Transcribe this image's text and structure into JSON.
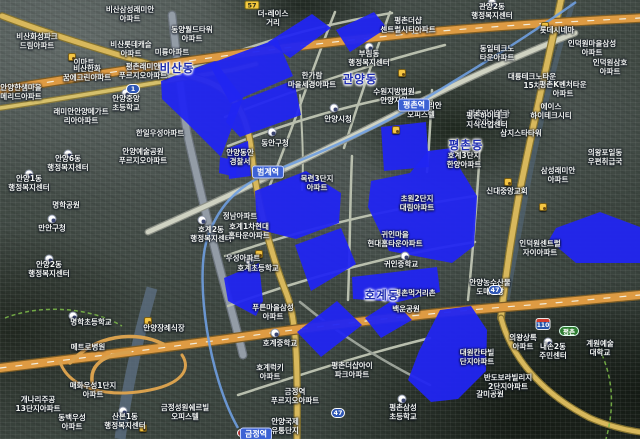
{
  "map": {
    "colors": {
      "zone_fill": "#2125f1",
      "district_text": "#1d2bb0",
      "highway": "#de9b43",
      "highway_casing": "#7d5d26",
      "arterial": "#d8b85c",
      "arterial_casing": "#87742f",
      "minor_road": "#b9bfae",
      "major_gray_road": "#939ca6",
      "subway_line": "#6f9fe0",
      "stream": "#5d7085",
      "park_border": "#7ab648"
    },
    "district_labels": [
      {
        "text": "비산동",
        "x": 177,
        "y": 68
      },
      {
        "text": "관양동",
        "x": 360,
        "y": 79
      },
      {
        "text": "평촌동",
        "x": 466,
        "y": 145
      },
      {
        "text": "호계동",
        "x": 382,
        "y": 295
      }
    ],
    "station_labels": [
      {
        "text": "평촌역",
        "x": 414,
        "y": 105
      },
      {
        "text": "범계역",
        "x": 268,
        "y": 172
      },
      {
        "text": "금정역",
        "x": 256,
        "y": 434
      }
    ],
    "shields": [
      {
        "style": "local",
        "text": "57",
        "x": 252,
        "y": 5
      },
      {
        "style": "national",
        "text": "1",
        "x": 133,
        "y": 89
      },
      {
        "style": "national",
        "text": "47",
        "x": 338,
        "y": 413
      },
      {
        "style": "national",
        "text": "47",
        "x": 495,
        "y": 290
      },
      {
        "style": "expwy",
        "text": "110",
        "x": 543,
        "y": 324
      },
      {
        "style": "ic",
        "text": "평촌",
        "x": 569,
        "y": 331
      }
    ],
    "place_labels": [
      {
        "l": [
          "비산삼성래미안",
          "아파트"
        ],
        "x": 130,
        "y": 14
      },
      {
        "l": [
          "동양월드타워",
          "아파트"
        ],
        "x": 192,
        "y": 34
      },
      {
        "l": [
          "비산화성파크",
          "드림아파트"
        ],
        "x": 37,
        "y": 41
      },
      {
        "l": [
          "비산롯데캐슬",
          "아파트"
        ],
        "x": 131,
        "y": 49
      },
      {
        "l": [
          "미륭아파트"
        ],
        "x": 172,
        "y": 52
      },
      {
        "l": [
          "이마트"
        ],
        "x": 84,
        "y": 62
      },
      {
        "l": [
          "비산한화",
          "꿈에그린아파트"
        ],
        "x": 87,
        "y": 73
      },
      {
        "l": [
          "평촌래미안",
          "푸르지오아파트"
        ],
        "x": 143,
        "y": 71
      },
      {
        "l": [
          "안양한샘마을",
          "메리드아파트"
        ],
        "x": 21,
        "y": 92
      },
      {
        "l": [
          "안양중앙",
          "초등학교"
        ],
        "x": 126,
        "y": 103
      },
      {
        "l": [
          "래미안안양메가트",
          "리아아파트"
        ],
        "x": 81,
        "y": 116
      },
      {
        "l": [
          "한일우성아파트"
        ],
        "x": 160,
        "y": 133
      },
      {
        "l": [
          "더-레이스",
          "거리"
        ],
        "x": 273,
        "y": 18
      },
      {
        "l": [
          "평촌더샵",
          "센트럴시티아파트"
        ],
        "x": 408,
        "y": 25
      },
      {
        "l": [
          "부림동",
          "행정복지센터"
        ],
        "x": 369,
        "y": 58
      },
      {
        "l": [
          "한가람",
          "마을세경아파트"
        ],
        "x": 312,
        "y": 80
      },
      {
        "l": [
          "안양시청"
        ],
        "x": 338,
        "y": 119
      },
      {
        "l": [
          "효성인텔리안",
          "오피스텔"
        ],
        "x": 421,
        "y": 110
      },
      {
        "l": [
          "수원지방법원",
          "안양지원"
        ],
        "x": 394,
        "y": 96
      },
      {
        "l": [
          "동안구청"
        ],
        "x": 275,
        "y": 143
      },
      {
        "l": [
          "관양2동",
          "행정복지센터"
        ],
        "x": 492,
        "y": 11
      },
      {
        "l": [
          "롯데시네마"
        ],
        "x": 557,
        "y": 30
      },
      {
        "l": [
          "인덕원마을삼성",
          "아파트"
        ],
        "x": 592,
        "y": 48
      },
      {
        "l": [
          "동일테크노",
          "타운아파트"
        ],
        "x": 497,
        "y": 53
      },
      {
        "l": [
          "인덕원삼호",
          "아파트"
        ],
        "x": 610,
        "y": 67
      },
      {
        "l": [
          "대륭테크노타운",
          "15차"
        ],
        "x": 532,
        "y": 81
      },
      {
        "l": [
          "평촌K벤처타운",
          "아파트"
        ],
        "x": 563,
        "y": 89
      },
      {
        "l": [
          "에이스",
          "하이테크시티"
        ],
        "x": 551,
        "y": 111
      },
      {
        "l": [
          "평촌자이엘라",
          "오피스텔"
        ],
        "x": 489,
        "y": 118
      },
      {
        "l": [
          "삼지스타타워"
        ],
        "x": 521,
        "y": 133
      },
      {
        "l": [
          "평촌하이테크",
          "지식산업센터"
        ],
        "x": 487,
        "y": 120
      },
      {
        "l": [
          "호계3단지",
          "한양아파트"
        ],
        "x": 464,
        "y": 160
      },
      {
        "l": [
          "삼성래미안",
          "아파트"
        ],
        "x": 558,
        "y": 175
      },
      {
        "l": [
          "의왕포일동",
          "우편취급국"
        ],
        "x": 605,
        "y": 157
      },
      {
        "l": [
          "신대중앙교회"
        ],
        "x": 507,
        "y": 191
      },
      {
        "l": [
          "내손2동",
          "주민센터"
        ],
        "x": 553,
        "y": 351
      },
      {
        "l": [
          "인덕원센트럴",
          "자이아파트"
        ],
        "x": 540,
        "y": 248
      },
      {
        "l": [
          "안양6동",
          "행정복지센터"
        ],
        "x": 68,
        "y": 163
      },
      {
        "l": [
          "안양예술공원",
          "푸르지오아파트"
        ],
        "x": 143,
        "y": 156
      },
      {
        "l": [
          "안양1동",
          "행정복지센터"
        ],
        "x": 29,
        "y": 183
      },
      {
        "l": [
          "명학공원"
        ],
        "x": 66,
        "y": 205
      },
      {
        "l": [
          "만안구청"
        ],
        "x": 52,
        "y": 228
      },
      {
        "l": [
          "호계2동",
          "행정복지센터"
        ],
        "x": 211,
        "y": 234
      },
      {
        "l": [
          "안양2동",
          "행정복지센터"
        ],
        "x": 49,
        "y": 269
      },
      {
        "l": [
          "안양동안",
          "경찰서"
        ],
        "x": 240,
        "y": 157
      },
      {
        "l": [
          "정남아파트"
        ],
        "x": 240,
        "y": 216
      },
      {
        "l": [
          "호계1차현대",
          "홈타운아파트"
        ],
        "x": 249,
        "y": 231
      },
      {
        "l": [
          "우성아파트"
        ],
        "x": 243,
        "y": 258
      },
      {
        "l": [
          "호계초등학교"
        ],
        "x": 258,
        "y": 268
      },
      {
        "l": [
          "목련3단지",
          "아파트"
        ],
        "x": 317,
        "y": 183
      },
      {
        "l": [
          "초원2단지",
          "대림아파트"
        ],
        "x": 417,
        "y": 203
      },
      {
        "l": [
          "귀인마을",
          "현대홈타운아파트"
        ],
        "x": 395,
        "y": 239
      },
      {
        "l": [
          "귀인중학교"
        ],
        "x": 401,
        "y": 264
      },
      {
        "l": [
          "안양농수산물",
          "도매시장"
        ],
        "x": 490,
        "y": 287
      },
      {
        "l": [
          "평촌먹거리촌"
        ],
        "x": 415,
        "y": 293
      },
      {
        "l": [
          "백운공원"
        ],
        "x": 406,
        "y": 309
      },
      {
        "l": [
          "갈미공원"
        ],
        "x": 490,
        "y": 394
      },
      {
        "l": [
          "계원예술",
          "대학교"
        ],
        "x": 600,
        "y": 348
      },
      {
        "l": [
          "대원칸타빌",
          "단지아파트"
        ],
        "x": 477,
        "y": 357
      },
      {
        "l": [
          "반도보라빌리지",
          "2단지아파트"
        ],
        "x": 508,
        "y": 382
      },
      {
        "l": [
          "의왕상록",
          "아파트"
        ],
        "x": 523,
        "y": 342
      },
      {
        "l": [
          "명학초등학교"
        ],
        "x": 91,
        "y": 322
      },
      {
        "l": [
          "메트로병원"
        ],
        "x": 88,
        "y": 347
      },
      {
        "l": [
          "안양장례식장"
        ],
        "x": 164,
        "y": 328
      },
      {
        "l": [
          "매화우성1단지",
          "아파트"
        ],
        "x": 93,
        "y": 390
      },
      {
        "l": [
          "개나리주공",
          "13단지아파트"
        ],
        "x": 38,
        "y": 404
      },
      {
        "l": [
          "동백우성",
          "아파트"
        ],
        "x": 72,
        "y": 422
      },
      {
        "l": [
          "산본1동",
          "행정복지센터"
        ],
        "x": 125,
        "y": 421
      },
      {
        "l": [
          "금정성원쉐르빌",
          "오피스텔"
        ],
        "x": 185,
        "y": 412
      },
      {
        "l": [
          "금정역",
          "푸르지오아파트"
        ],
        "x": 295,
        "y": 396
      },
      {
        "l": [
          "안양국제",
          "유통단지"
        ],
        "x": 285,
        "y": 426
      },
      {
        "l": [
          "푸른마을삼성",
          "아파트"
        ],
        "x": 273,
        "y": 312
      },
      {
        "l": [
          "호계중학교"
        ],
        "x": 280,
        "y": 343
      },
      {
        "l": [
          "호계럭키",
          "아파트"
        ],
        "x": 270,
        "y": 372
      },
      {
        "l": [
          "평촌더샵아이",
          "파크아파트"
        ],
        "x": 352,
        "y": 370
      },
      {
        "l": [
          "평촌삼성",
          "초등학교"
        ],
        "x": 403,
        "y": 412
      }
    ],
    "markers": [
      {
        "type": "civic",
        "x": 369,
        "y": 47
      },
      {
        "type": "civic",
        "x": 334,
        "y": 108
      },
      {
        "type": "civic",
        "x": 272,
        "y": 132
      },
      {
        "type": "civic",
        "x": 492,
        "y": 3
      },
      {
        "type": "civic",
        "x": 126,
        "y": 93
      },
      {
        "type": "civic",
        "x": 68,
        "y": 154
      },
      {
        "type": "civic",
        "x": 29,
        "y": 174
      },
      {
        "type": "civic",
        "x": 52,
        "y": 219
      },
      {
        "type": "civic",
        "x": 202,
        "y": 220
      },
      {
        "type": "civic",
        "x": 49,
        "y": 259
      },
      {
        "type": "civic",
        "x": 250,
        "y": 261
      },
      {
        "type": "civic",
        "x": 275,
        "y": 333
      },
      {
        "type": "civic",
        "x": 405,
        "y": 256
      },
      {
        "type": "civic",
        "x": 402,
        "y": 399
      },
      {
        "type": "civic",
        "x": 548,
        "y": 342
      },
      {
        "type": "civic",
        "x": 123,
        "y": 411
      },
      {
        "type": "civic",
        "x": 73,
        "y": 316
      },
      {
        "type": "poi",
        "x": 72,
        "y": 57
      },
      {
        "type": "poi",
        "x": 545,
        "y": 26
      },
      {
        "type": "poi",
        "x": 508,
        "y": 182
      },
      {
        "type": "poi",
        "x": 259,
        "y": 254
      },
      {
        "type": "poi",
        "x": 148,
        "y": 321
      },
      {
        "type": "poi",
        "x": 402,
        "y": 73
      },
      {
        "type": "poi",
        "x": 396,
        "y": 130
      },
      {
        "type": "poi",
        "x": 543,
        "y": 207
      },
      {
        "type": "poi",
        "x": 143,
        "y": 428
      },
      {
        "type": "rail",
        "x": 241,
        "y": 433
      }
    ],
    "zones": [
      "268,42 312,14 331,28 290,58",
      "336,30 374,12 387,28 350,52",
      "209,64 277,39 293,76 230,103",
      "161,81 215,61 243,98 221,157 186,122 162,99",
      "232,104 294,80 301,115 240,137 226,122",
      "227,149 248,141 251,176 229,179",
      "220,157 237,161 236,177 219,173",
      "255,191 306,171 341,193 339,223 296,239 257,229",
      "295,245 341,228 356,264 311,291",
      "224,278 259,263 263,301 256,316 228,301",
      "297,332 337,301 362,325 321,357",
      "365,318 393,300 412,320 381,338",
      "352,277 437,267 440,292 398,302 353,299",
      "381,127 426,122 429,167 384,171",
      "371,181 410,173 428,151 452,148 461,170 477,196 474,246 452,263 389,251 368,207",
      "556,228 600,212 640,227 640,263 576,263 549,240",
      "440,310 471,306 487,330 486,371 458,399 431,402 408,380 419,351"
    ],
    "streams": [
      {
        "path": "M152,288 C140,330 128,380 120,439",
        "color": "#5d7085",
        "w": 11,
        "op": 0.75
      },
      {
        "path": "M573,2 C552,70 536,140 524,205 C518,240 512,268 507,300",
        "color": "#53677a",
        "w": 5,
        "op": 0.6
      }
    ],
    "park_borders": [
      {
        "path": "M5,318 C40,304 90,307 122,326"
      },
      {
        "path": "M596,342 C612,372 616,402 606,439"
      }
    ],
    "roads": [
      {
        "name": "rd-gyeongsu",
        "path": "M172,15 C178,70 182,100 187,133 C200,190 214,250 230,305 C236,327 240,342 243,355",
        "w": 6.5,
        "color": "#939ca6",
        "casing": "#6c747d"
      },
      {
        "name": "rd-minor-1",
        "path": "M163,79 C240,48 310,26 392,13",
        "w": 2.5,
        "color": "#b9bfae"
      },
      {
        "name": "rd-minor-2",
        "path": "M225,117 C300,88 370,64 445,45",
        "w": 2.5,
        "color": "#b9bfae"
      },
      {
        "name": "rd-minor-3",
        "path": "M335,12 C312,70 292,130 270,185",
        "w": 2.5,
        "color": "#b9bfae"
      },
      {
        "name": "rd-minor-4",
        "path": "M390,12 C372,62 356,110 344,148",
        "w": 2.5,
        "color": "#b9bfae"
      },
      {
        "name": "rd-minor-5",
        "path": "M228,146 C290,122 350,104 420,92",
        "w": 2.5,
        "color": "#b9bfae"
      },
      {
        "name": "rd-minor-6",
        "path": "M225,256 C300,230 380,210 475,196",
        "w": 2.5,
        "color": "#b9bfae"
      },
      {
        "name": "rd-minor-7",
        "path": "M228,306 C310,276 390,255 475,242",
        "w": 2.5,
        "color": "#b9bfae"
      },
      {
        "name": "rd-minor-8",
        "path": "M352,156 C350,200 350,250 348,300",
        "w": 2.5,
        "color": "#b9bfae"
      },
      {
        "name": "rd-minor-9",
        "path": "M432,90 C430,130 428,160 427,172",
        "w": 2.5,
        "color": "#b9bfae"
      },
      {
        "name": "rd-minor-10",
        "path": "M480,150 C477,200 473,250 468,300",
        "w": 2.5,
        "color": "#b9bfae"
      },
      {
        "name": "rd-minor-11",
        "path": "M300,95 C302,130 304,160 302,190",
        "w": 2,
        "color": "#b9bfae"
      },
      {
        "name": "rd-minor-12",
        "path": "M238,395 C300,375 360,355 430,338",
        "w": 2.5,
        "color": "#b9bfae"
      },
      {
        "name": "rd-minor-13",
        "path": "M300,302 C340,335 380,360 430,385",
        "w": 2.5,
        "color": "#9aa198"
      },
      {
        "name": "rd-simin",
        "path": "M148,232 C230,196 330,148 416,104 C465,79 520,55 575,33",
        "w": 4.5,
        "color": "#cfd2c2",
        "casing": "#8d9188"
      },
      {
        "name": "rd-top-2",
        "path": "M0,108 C80,96 160,82 232,70 C240,68 248,66 256,64",
        "w": 3.5,
        "color": "#d6c06b",
        "casing": "#8a7a3a"
      },
      {
        "name": "rd-west-arterial",
        "path": "M2,16 C70,42 150,64 203,80 C237,91 247,118 251,148 C256,198 270,252 287,295 C296,318 298,360 297,439",
        "w": 5,
        "color": "#d8b85c",
        "casing": "#87742f"
      },
      {
        "name": "rd-east-47",
        "path": "M561,0 C548,60 532,130 519,195 C512,235 506,270 501,318",
        "w": 5.5,
        "color": "#d8b85c",
        "casing": "#87742f"
      },
      {
        "name": "rd-east-47b",
        "path": "M501,318 C512,360 545,395 590,418 C606,425 625,430 640,432",
        "w": 4.5,
        "color": "#d8b85c",
        "casing": "#87742f"
      },
      {
        "name": "hwy-top",
        "path": "M0,90 C110,72 240,52 370,38 C460,28 560,22 640,18",
        "w": 7.5,
        "color": "#de9b43",
        "casing": "#7d5d26"
      },
      {
        "name": "hwy-top-dash",
        "path": "M0,90 C110,72 240,52 370,38 C460,28 560,22 640,18",
        "w": 1.2,
        "color": "#f2ecda",
        "dash": "6 10"
      },
      {
        "name": "hwy-belt",
        "path": "M0,368 C90,357 180,346 270,333 C360,321 450,311 530,305 C567,302 605,298 640,295",
        "w": 8,
        "color": "#de9b43",
        "casing": "#7d5d26"
      },
      {
        "name": "hwy-belt-dash",
        "path": "M0,368 C90,357 180,346 270,333 C360,321 450,311 530,305 C567,302 605,298 640,295",
        "w": 1.2,
        "color": "#f2ecda",
        "dash": "6 10"
      },
      {
        "name": "hwy-ramp-1",
        "path": "M70,363 C95,335 135,330 163,344",
        "w": 3.5,
        "color": "#d9a14e"
      },
      {
        "name": "hwy-ramp-2",
        "path": "M95,392 C85,368 100,355 130,352",
        "w": 3.5,
        "color": "#d9a14e"
      },
      {
        "name": "hwy-ramp-3",
        "path": "M60,362 C70,390 110,398 150,390 C180,384 192,370 182,355",
        "w": 3,
        "color": "#d9a14e"
      }
    ],
    "subway_line": {
      "name": "line-4",
      "path": "M576,2 C505,52 452,82 415,105 C372,131 312,156 269,173 C237,186 216,208 206,243 C196,282 208,375 238,428",
      "color": "#6f9fe0",
      "w": 2.5
    }
  }
}
